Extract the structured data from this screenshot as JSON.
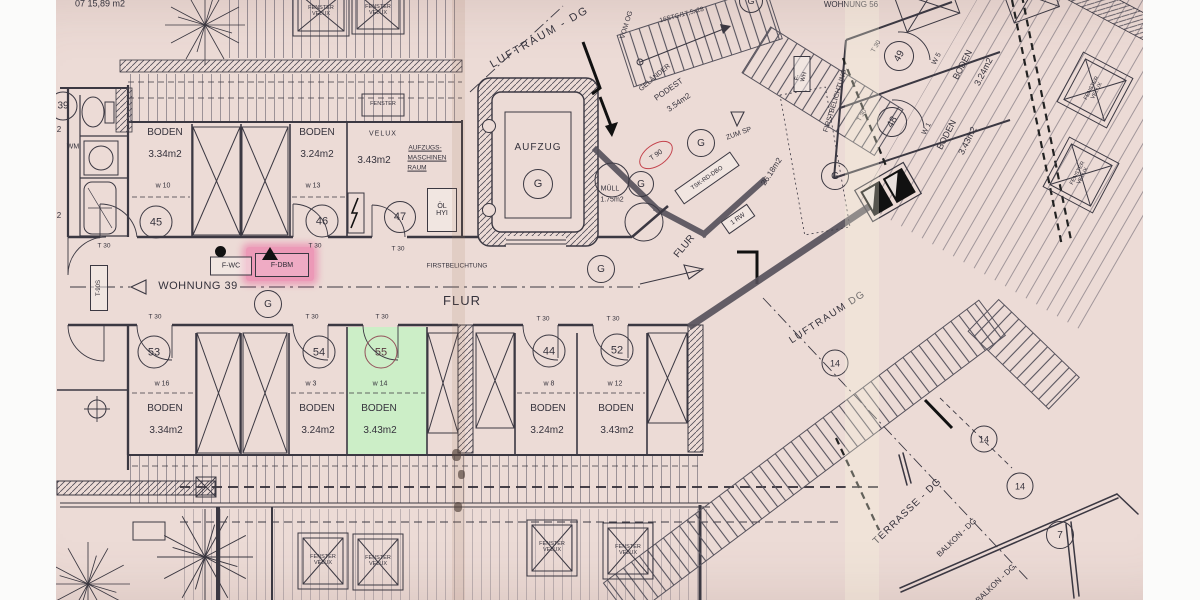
{
  "palette": {
    "paper": "#ecdbd6",
    "ink": "#3b3842",
    "highlight_pink": "#eb3e8c",
    "highlight_green": "#c9f0c5",
    "red_marking": "#c3414b"
  },
  "notes": {
    "corner": "07  15,89 m2",
    "wohnung56": "WOHNUNG 56",
    "wohnung39": "WOHNUNG 39"
  },
  "labels": {
    "g": "G",
    "t30": "T 30",
    "t90": "T 90",
    "t90s": "T-90S",
    "c39": "39",
    "c14": "14",
    "c7": "7",
    "flur": "FLUR",
    "flur_diag": "FLUR",
    "firstbelichtung": "FIRSTBELICHTUNG",
    "firstbelichtung_dot": "FIRSTBELICHTUNG.",
    "f_wc": "F-WC",
    "f_dbm": "F-DBM",
    "f_wh": "F-WH",
    "wm": "WM",
    "cut_m2": "2",
    "luftraum_top": "LUFTRAUM - DG",
    "luftraum_bottom": "LUFTRAUM  DG",
    "terrasse": "TERRASSE - DG",
    "balkon": "BALKON - DG",
    "balkon2": "BALKON - DG",
    "fenster": "FENSTER",
    "velux": "VELUX"
  },
  "stairwell": {
    "aufzug": "AUFZUG",
    "vom_og": "VOM OG",
    "stg": "16STG/17,5x28",
    "gelaender": "GELÄNDER",
    "podest": "PODEST",
    "podest_area": "3.54m2",
    "zum_sp": "ZUM SP",
    "muell": "MÜLL",
    "muell_area": "1.75m2",
    "area_note": "26.18m2",
    "tsk": "TSK-RD-DBO",
    "rw": "1 RW"
  },
  "machine_room": {
    "line1": "AUFZUGS-",
    "line2": "MASCHINEN",
    "line3": "RAUM",
    "oel1": "ÖL",
    "oel2": "HYI",
    "velux": "VELUX",
    "area": "3.43m2"
  },
  "rooms": {
    "top": [
      {
        "no": "45",
        "unit": "w 10",
        "name": "BODEN",
        "area": "3.34m2"
      },
      {
        "no": "46",
        "unit": "w 13",
        "name": "BODEN",
        "area": "3.24m2"
      },
      {
        "no": "47"
      }
    ],
    "bottom": [
      {
        "no": "53",
        "unit": "w 16",
        "name": "BODEN",
        "area": "3.34m2"
      },
      {
        "no": "54",
        "unit": "w 3",
        "name": "BODEN",
        "area": "3.24m2"
      },
      {
        "no": "55",
        "unit": "w 14",
        "name": "BODEN",
        "area": "3.43m2"
      },
      {
        "no": "44",
        "unit": "w 8",
        "name": "BODEN",
        "area": "3.24m2"
      },
      {
        "no": "52",
        "unit": "w 12",
        "name": "BODEN",
        "area": "3.43m2"
      }
    ],
    "wing": [
      {
        "no": "49",
        "unit": "W 5",
        "name": "BODEN",
        "area": "3.24m2"
      },
      {
        "no": "48",
        "unit": "W 1",
        "name": "BODEN",
        "area": "3.43m2"
      }
    ]
  }
}
